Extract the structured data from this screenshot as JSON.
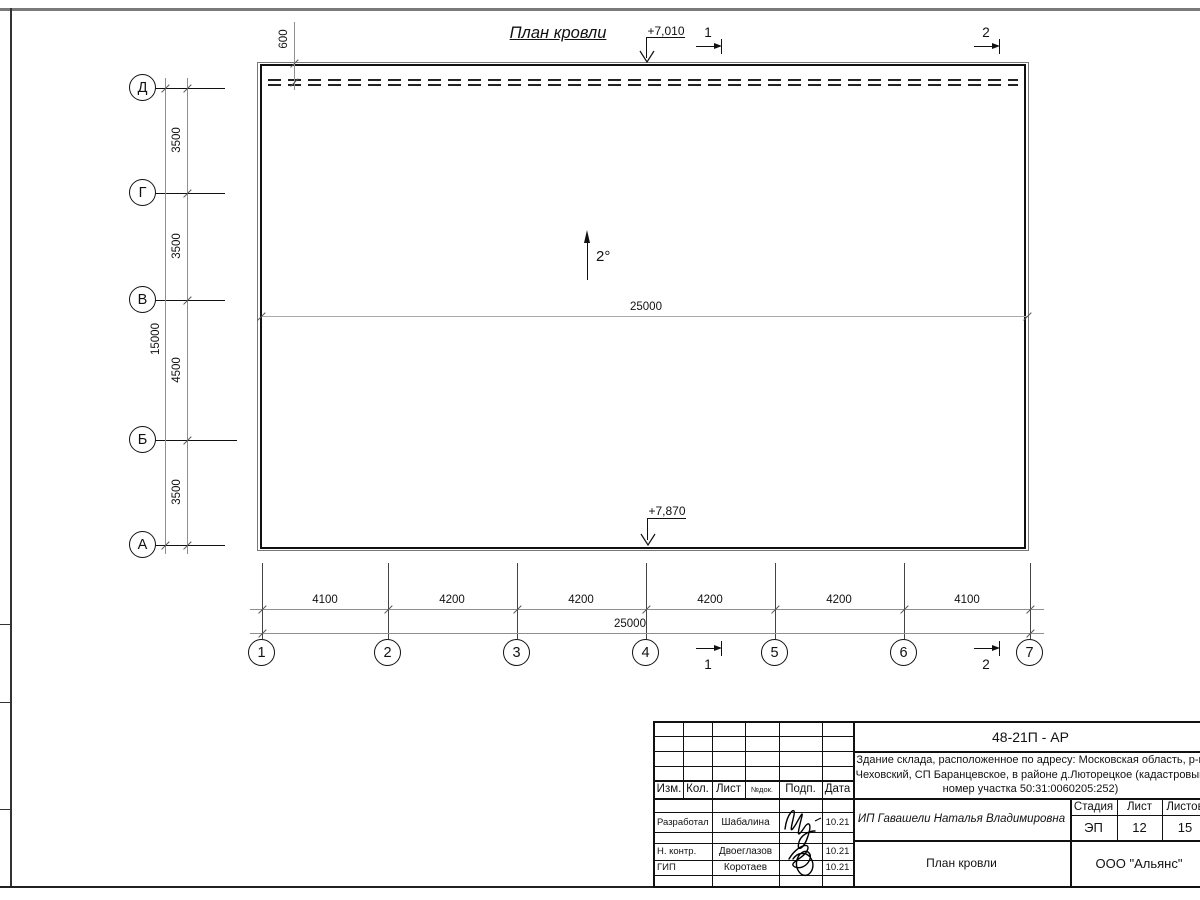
{
  "palette": {
    "ink": "#111111",
    "dim_line": "#8f8f8f",
    "frame_gray": "#7a7a7a"
  },
  "drawing": {
    "title": "План кровли",
    "slope": "2°",
    "elevation_top": "+7,010",
    "elevation_bottom": "+7,870",
    "ridge_dim": "25000",
    "section_top_1": "1",
    "section_top_2": "2",
    "section_bottom_1": "1",
    "section_bottom_2": "2"
  },
  "axes": {
    "vertical": [
      "Д",
      "Г",
      "В",
      "Б",
      "А"
    ],
    "horizontal": [
      "1",
      "2",
      "3",
      "4",
      "5",
      "6",
      "7"
    ]
  },
  "dims": {
    "top_offset": "600",
    "left_segments": [
      "3500",
      "3500",
      "4500",
      "3500"
    ],
    "left_total": "15000",
    "bottom_segments": [
      "4100",
      "4200",
      "4200",
      "4200",
      "4200",
      "4100"
    ],
    "bottom_total": "25000"
  },
  "titleblock": {
    "doc_number": "48-21П - АР",
    "address_line1": "Здание склада, расположенное по адресу: Московская область, р-н",
    "address_line2": "Чеховский, СП Баранцевское, в районе д.Люторецкое  (кадастровый",
    "address_line3": "номер участка 50:31:0060205:252)",
    "header_cols": [
      "Изм.",
      "Кол.",
      "Лист",
      "№док.",
      "Подп.",
      "Дата"
    ],
    "rows": [
      {
        "role": "Разработал",
        "name": "Шабалина",
        "date": "10.21"
      },
      {
        "role": "Н. контр.",
        "name": "Двоеглазов",
        "date": "10.21"
      },
      {
        "role": "ГИП",
        "name": "Коротаев",
        "date": "10.21"
      }
    ],
    "client": "ИП Гавашели Наталья Владимировна",
    "stage_label": "Стадия",
    "sheet_label": "Лист",
    "sheets_label": "Листов",
    "stage": "ЭП",
    "sheet": "12",
    "sheets": "15",
    "sheet_title": "План кровли",
    "company": "ООО \"Альянс\""
  }
}
